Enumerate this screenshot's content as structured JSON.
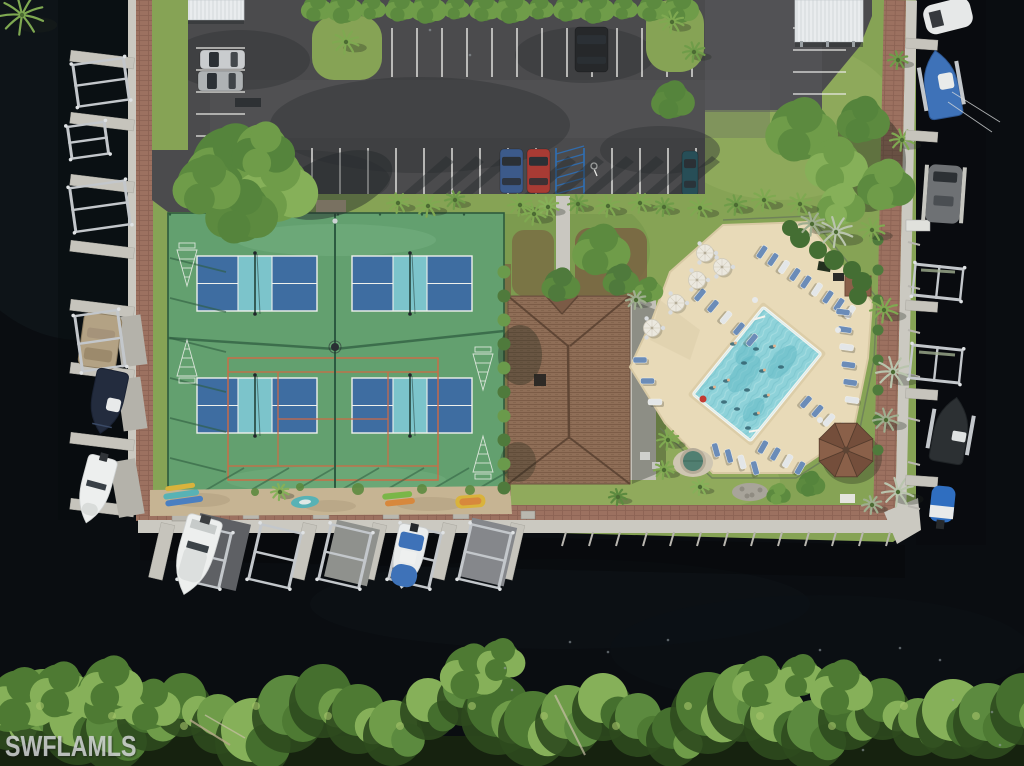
{
  "watermark": {
    "text": "SWFLAMLS"
  },
  "scene": {
    "type": "aerial-photo",
    "features": [
      "marina-canal",
      "boat-docks",
      "pickleball-courts",
      "shuffleboard-courts",
      "clubhouse-roof",
      "swimming-pool",
      "pool-deck",
      "parking-lot",
      "kayak-rack",
      "gazebo",
      "spa",
      "mangrove-shoreline",
      "palm-trees"
    ]
  },
  "palette": {
    "water": "#0a0d11",
    "waterGlow": "#151c21",
    "waterStreak": "#0e1318",
    "grass": "#86a355",
    "grassLight": "#9ab264",
    "grassDark": "#6b8c45",
    "treeDark": "#456f2e",
    "treeMid": "#5c8a3f",
    "treeLight": "#7fa951",
    "treeOlive": "#6f9c49",
    "treePale": "#86b059",
    "palmSilver": "#b9c4ad",
    "palmGray": "#9fae8f",
    "asphalt": "#4b4b4d",
    "asphaltLight": "#5a5a5d",
    "asphaltDark": "#303236",
    "lineWhite": "#e9e9e6",
    "hcBlue": "#2f6fb5",
    "courtGreen": "#63a06f",
    "courtGreenEdge": "#2e5a3d",
    "courtBlue": "#3e6da1",
    "courtTeal": "#7cc4cb",
    "courtOrange": "#cf6a45",
    "netDark": "#23423a",
    "fenceShadow": "#2f5d40",
    "courtWorn": "#78b183",
    "sand": "#c6b493",
    "sandDark": "#b2a081",
    "brick": "#9c7160",
    "brickLine": "#8a6152",
    "concrete": "#c6c4bc",
    "concreteDark": "#a9a79f",
    "seawall": "#cbc9c1",
    "deck": "#e8dab8",
    "deckShade": "#d8c9a4",
    "poolWater": "#8ed2d9",
    "poolDeep": "#5fb7c4",
    "poolLight": "#b5e4e8",
    "coping": "#f4f4ef",
    "roof": "#8f6e57",
    "roofLine": "#7a5a45",
    "roofRidge": "#5f4635",
    "metal": "#c3c7cb",
    "metalDark": "#8e9296",
    "canopyGray": "#5e6064",
    "white": "#edefee",
    "offWhite": "#dfe2e2",
    "glass": "#2b3035",
    "navyBoat": "#232c3e",
    "blueCover": "#3e72b8",
    "tanBoat": "#b3a284",
    "darkBoat": "#2c3033",
    "chairBlue": "#6b8cb8",
    "chairWhite": "#e3e6e8",
    "umbrella": "#ebe8df",
    "silverCar": "#c9ccce",
    "silverCar2": "#aeb2b4",
    "suvDark": "#26282a",
    "blueCar": "#3c5a8a",
    "redCar": "#a83b34",
    "tealCar": "#274e57",
    "kayakTeal": "#58b2b5",
    "kayakBlue": "#4a7fc1",
    "kayakYellow": "#d9b33c",
    "kayakGreen": "#7ab648",
    "kayakOrange": "#d7883d",
    "spaCover": "#517f71",
    "stone": "#a8a49a",
    "gazebo": "#8a6049",
    "gazeboDark": "#744e3b",
    "mulch": "#7a5b40",
    "shadow": "#22281f"
  }
}
